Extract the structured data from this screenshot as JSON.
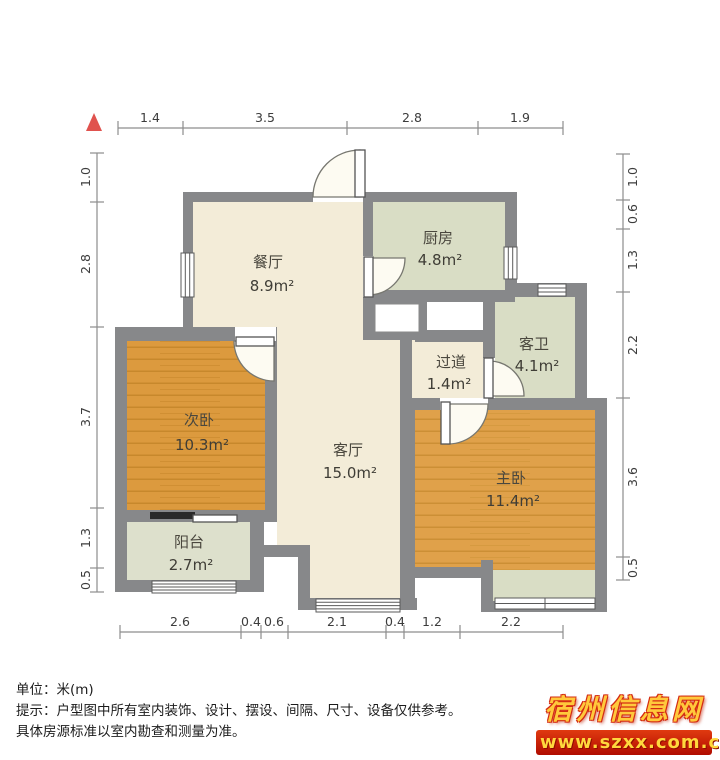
{
  "plan": {
    "north_indicator": "north-arrow",
    "rooms": [
      {
        "name": "餐厅",
        "area": "8.9m²"
      },
      {
        "name": "厨房",
        "area": "4.8m²"
      },
      {
        "name": "客卫",
        "area": "4.1m²"
      },
      {
        "name": "过道",
        "area": "1.4m²"
      },
      {
        "name": "次卧",
        "area": "10.3m²"
      },
      {
        "name": "客厅",
        "area": "15.0m²"
      },
      {
        "name": "主卧",
        "area": "11.4m²"
      },
      {
        "name": "阳台",
        "area": "2.7m²"
      }
    ],
    "dimensions_m": {
      "top": [
        "1.4",
        "3.5",
        "2.8",
        "1.9"
      ],
      "left": [
        "1.0",
        "2.8",
        "3.7",
        "1.3",
        "0.5"
      ],
      "right": [
        "1.0",
        "0.6",
        "1.3",
        "2.2",
        "3.6",
        "0.5"
      ],
      "bottom": [
        "2.6",
        "0.4",
        "0.6",
        "2.1",
        "0.4",
        "1.2",
        "2.2"
      ]
    },
    "colors": {
      "wall": "#87888a",
      "living_floor": "#f3ecd8",
      "wood_floor": "#dc9a3e",
      "tile_floor": "#d9ddc5",
      "north_red": "#e0524e"
    }
  },
  "notes": {
    "unit_line": "单位：米(m)",
    "tip_line1": "提示：户型图中所有室内装饰、设计、摆设、间隔、尺寸、设备仅供参考。",
    "tip_line2": "具体房源标准以室内勘查和测量为准。"
  },
  "watermark": {
    "site": "宿州信息网",
    "url": "www.szxx.com.cn"
  }
}
